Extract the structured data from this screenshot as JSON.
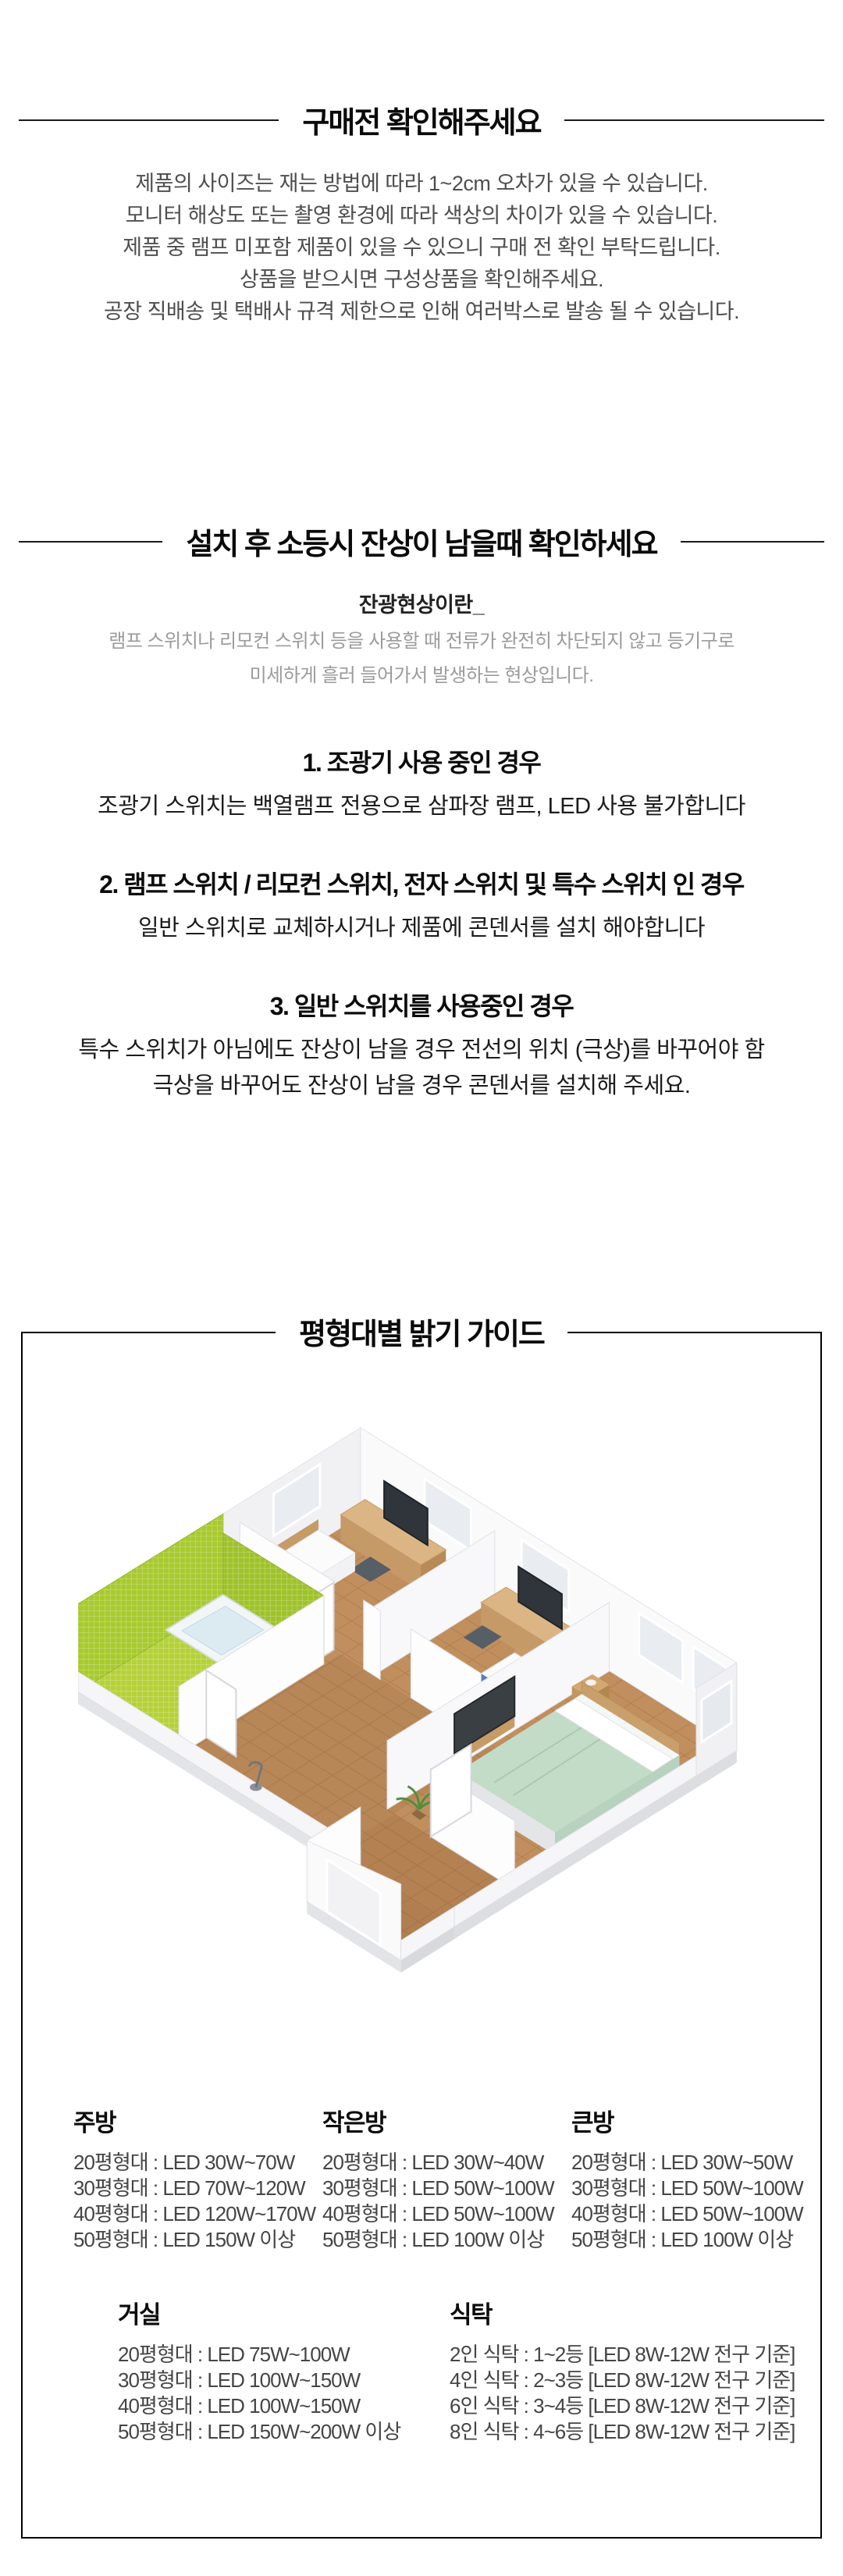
{
  "colors": {
    "text_dark": "#111111",
    "text_gray": "#4e4e4e",
    "text_light_gray": "#9b9b9b",
    "border": "#000000",
    "wood": "#c18f5e",
    "bath_green": "#b5d13a",
    "bed_mint": "#c2dcc8",
    "stripe_blue": "#5e7cb8"
  },
  "section_precheck": {
    "title": "구매전 확인해주세요",
    "lines": [
      "제품의 사이즈는 재는 방법에 따라 1~2cm 오차가 있을 수 있습니다.",
      "모니터 해상도 또는 촬영 환경에 따라 색상의 차이가 있을 수 있습니다.",
      "제품 중 램프 미포함 제품이 있을 수 있으니 구매 전 확인 부탁드립니다.",
      "상품을 받으시면 구성상품을 확인해주세요.",
      "공장 직배송 및 택배사 규격 제한으로 인해 여러박스로 발송 될 수 있습니다."
    ]
  },
  "section_afterglow": {
    "title": "설치 후 소등시 잔상이 남을때 확인하세요",
    "subtitle": "잔광현상이란_",
    "description": [
      "램프 스위치나 리모컨 스위치 등을 사용할 때 전류가 완전히 차단되지 않고 등기구로",
      "미세하게 흘러 들어가서 발생하는 현상입니다."
    ],
    "cases": [
      {
        "heading": "1. 조광기 사용 중인 경우",
        "body1": "조광기 스위치는 백열램프 전용으로 삼파장 램프, LED 사용 불가합니다",
        "body2": ""
      },
      {
        "heading": "2. 램프 스위치 / 리모컨 스위치, 전자 스위치 및 특수 스위치 인 경우",
        "body1": "일반 스위치로 교체하시거나 제품에 콘덴서를 설치 해야합니다",
        "body2": ""
      },
      {
        "heading": "3. 일반 스위치를 사용중인 경우",
        "body1": "특수 스위치가 아님에도 잔상이 남을 경우 전선의 위치 (극상)를 바꾸어야 함",
        "body2": "극상을 바꾸어도 잔상이 남을 경우 콘덴서를 설치해 주세요."
      }
    ]
  },
  "section_guide": {
    "title": "평형대별 밝기 가이드",
    "floorplan": "isometric-apartment-3d-floorplan",
    "row1": [
      {
        "header": "주방",
        "rows": [
          "20평형대 : LED 30W~70W",
          "30평형대 : LED 70W~120W",
          "40평형대 : LED 120W~170W",
          "50평형대 : LED 150W 이상"
        ]
      },
      {
        "header": "작은방",
        "rows": [
          "20평형대 : LED 30W~40W",
          "30평형대 : LED 50W~100W",
          "40평형대 : LED 50W~100W",
          "50평형대 : LED 100W 이상"
        ]
      },
      {
        "header": "큰방",
        "rows": [
          "20평형대 : LED 30W~50W",
          "30평형대 : LED 50W~100W",
          "40평형대 : LED 50W~100W",
          "50평형대 : LED 100W 이상"
        ]
      }
    ],
    "row2": [
      {
        "header": "거실",
        "rows": [
          "20평형대 : LED 75W~100W",
          "30평형대 : LED 100W~150W",
          "40평형대 : LED 100W~150W",
          "50평형대 : LED 150W~200W 이상"
        ]
      },
      {
        "header": "식탁",
        "rows": [
          "2인 식탁 : 1~2등 [LED 8W-12W 전구 기준]",
          "4인 식탁 : 2~3등 [LED 8W-12W 전구 기준]",
          "6인 식탁 : 3~4등 [LED 8W-12W 전구 기준]",
          "8인 식탁 : 4~6등 [LED 8W-12W 전구 기준]"
        ]
      }
    ]
  }
}
